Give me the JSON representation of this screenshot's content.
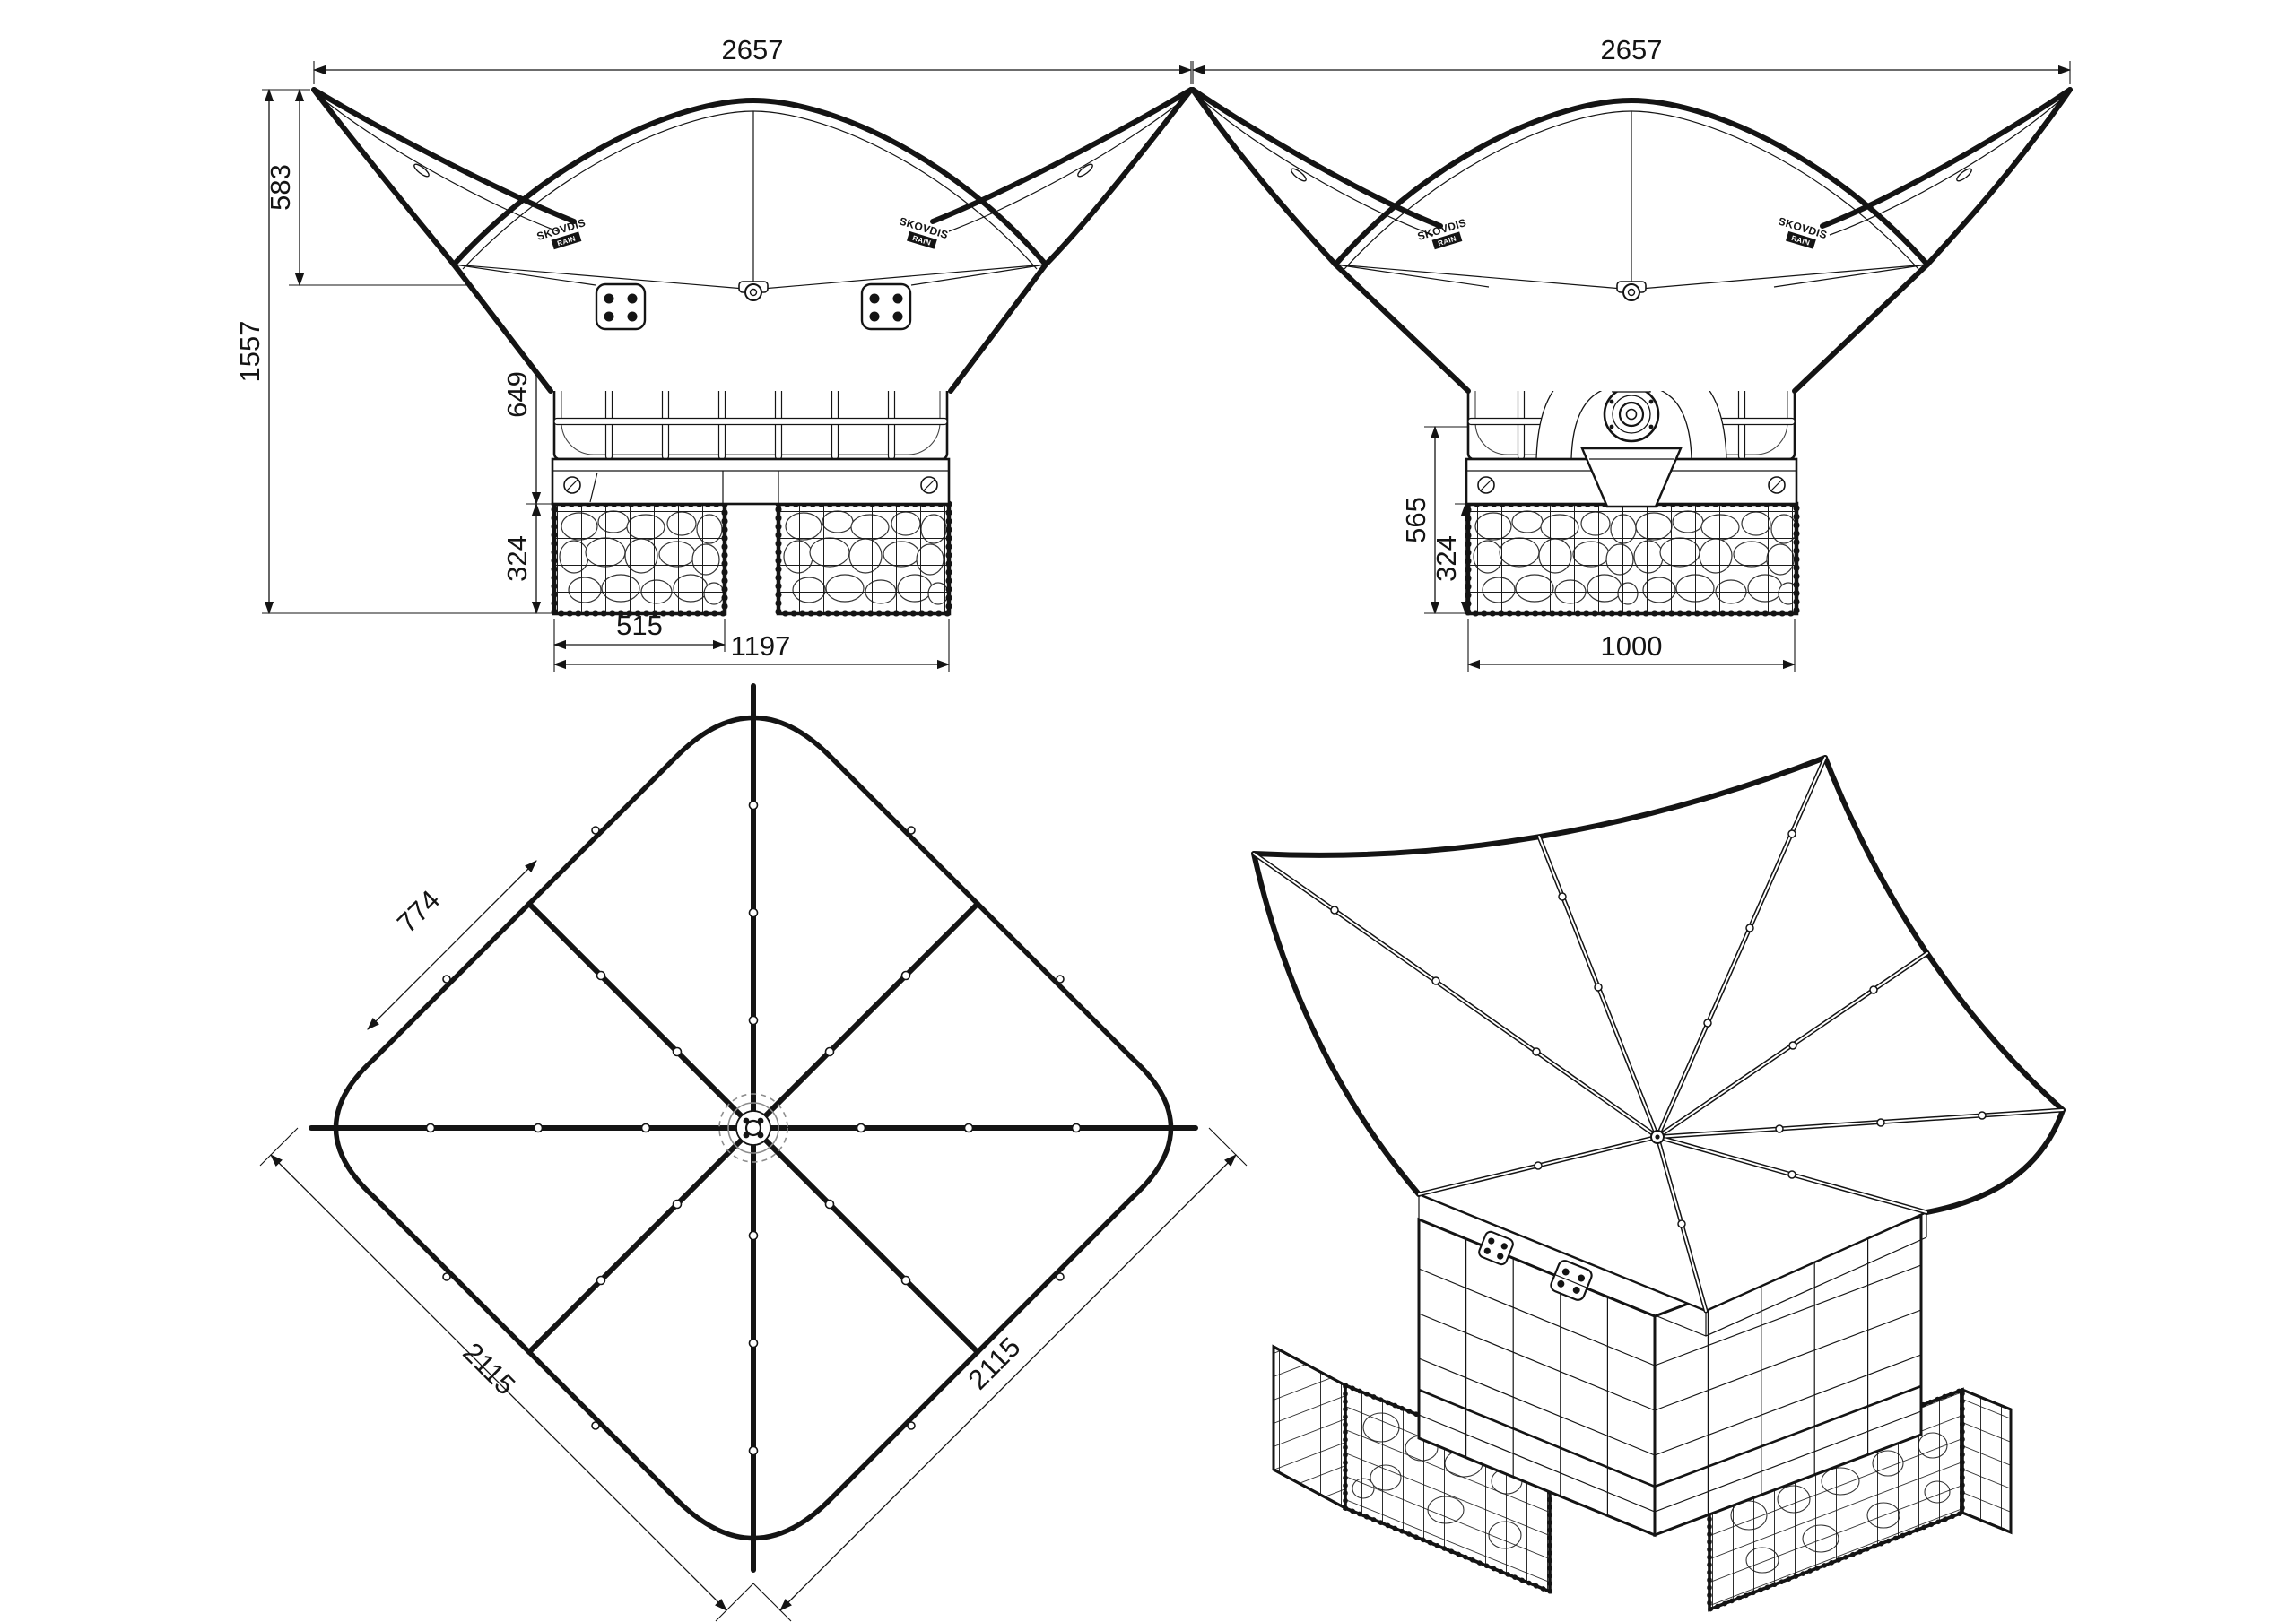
{
  "page": {
    "background": "#ffffff",
    "ink": "#141414",
    "muted": "#8c8c8c"
  },
  "logo": {
    "brand": "SKOVDIS",
    "tag": "RAIN"
  },
  "views": {
    "front": {
      "dims": {
        "overall_width": "2657",
        "canopy_height": "583",
        "overall_height": "1557",
        "tank_height": "649",
        "base_height": "324",
        "gabion_width": "515",
        "base_width": "1197"
      }
    },
    "side": {
      "dims": {
        "overall_width": "2657",
        "outlet_height": "565",
        "base_height": "324",
        "base_width": "1000"
      }
    },
    "plan": {
      "dims": {
        "panel_width": "774",
        "edge_left": "2115",
        "edge_right": "2115"
      }
    }
  }
}
